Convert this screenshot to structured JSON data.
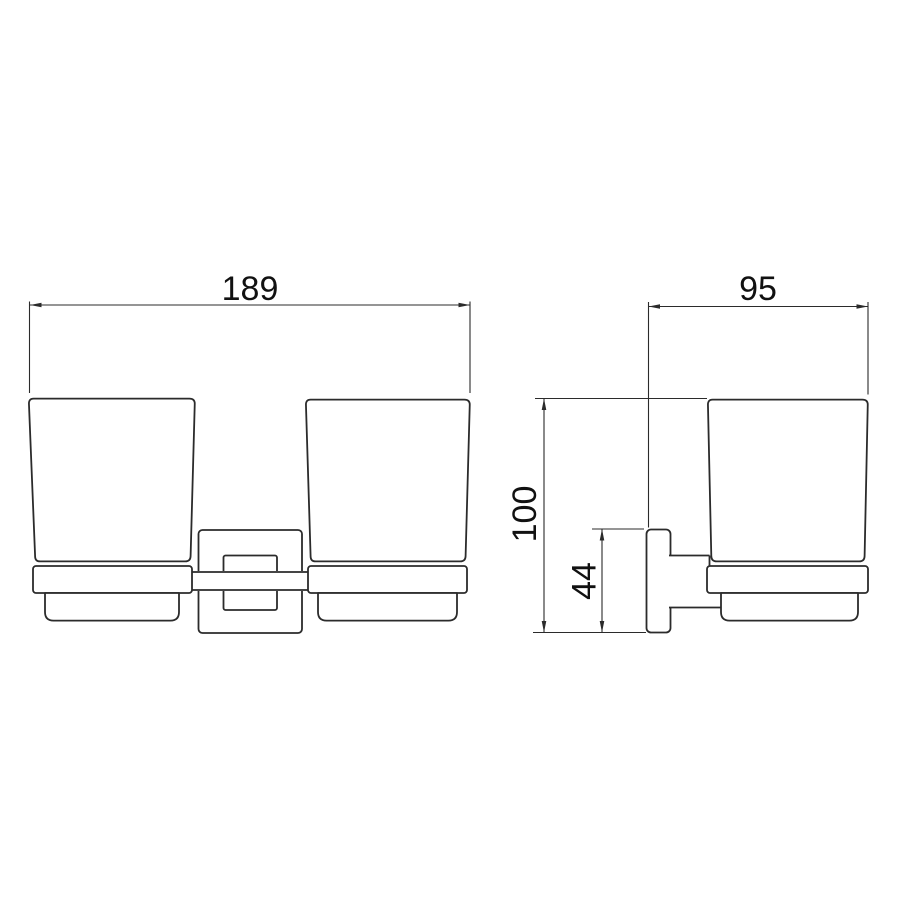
{
  "page": {
    "background": "#ffffff"
  },
  "drawing": {
    "line_color": "#2b2b2b",
    "text_color": "#111111",
    "front_view": {
      "width_dim_label": "189"
    },
    "side_view": {
      "depth_dim_label": "95",
      "height_dim_label": "100",
      "plate_height_dim_label": "44"
    }
  }
}
